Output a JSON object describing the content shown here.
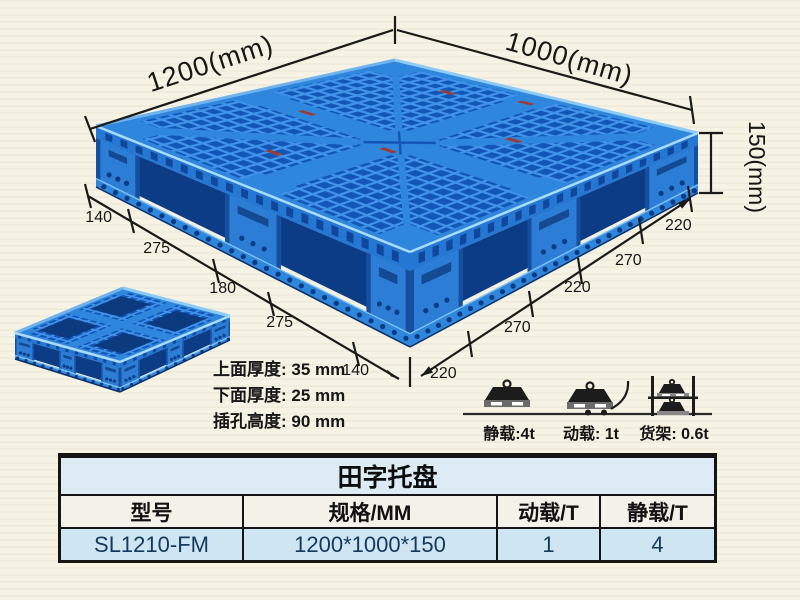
{
  "product_diagram": {
    "width_label": "1200(mm)",
    "depth_label": "1000(mm)",
    "height_label": "150(mm)",
    "bottom_left_segments": [
      "140",
      "275",
      "180",
      "275",
      "140"
    ],
    "bottom_right_segments": [
      "220",
      "270",
      "220",
      "270",
      "220"
    ]
  },
  "thickness_notes": {
    "top": "上面厚度: 35 mm",
    "bottom": "下面厚度: 25 mm",
    "socket": "插孔高度: 90 mm"
  },
  "load_ratings": {
    "static": "静载:4t",
    "dynamic": "动载: 1t",
    "rack": "货架: 0.6t"
  },
  "spec_table": {
    "title": "田字托盘",
    "headers": [
      "型号",
      "规格/MM",
      "动载/T",
      "静载/T"
    ],
    "rows": [
      [
        "SL1210-FM",
        "1200*1000*150",
        "1",
        "4"
      ]
    ]
  },
  "icons": {
    "static_load": "weight-block-icon",
    "dynamic_load": "weight-on-cart-icon",
    "rack_load": "rack-shelves-icon"
  },
  "colors": {
    "background": "#f6f2e4",
    "blue_main": "#2e86dd",
    "blue_hole": "#1456b8",
    "blue_rib": "#3f93e8",
    "blue_side": "#2478d4",
    "blue_pocket": "#0d3c86",
    "blue_foot": "#2b7dd6",
    "blue_foot_dark": "#174f9f",
    "blue_runner_hole": "#0c3a80",
    "edge_highlight": "#9fd4fa",
    "chip_red": "#a03a2e",
    "dimension_line": "#1a1a1a",
    "table_title_bg": "#dcebf4",
    "table_header_bg": "#f4f1e9",
    "table_row_bg": "#cfe6f2"
  }
}
